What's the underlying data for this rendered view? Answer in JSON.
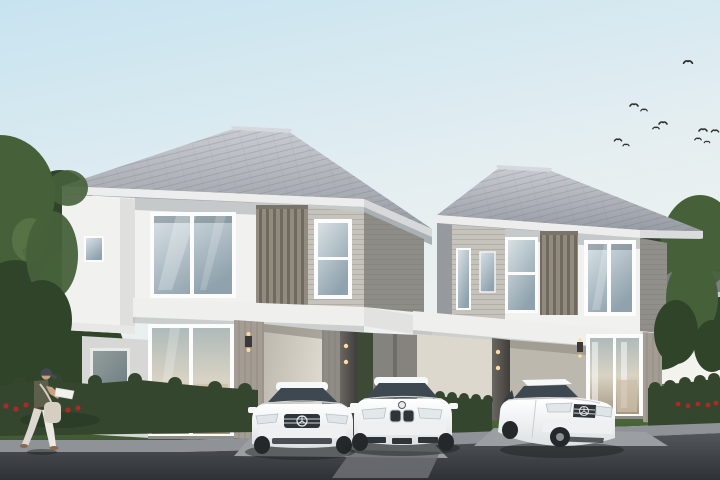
{
  "scene": {
    "description": "Daytime architectural rendering of two modern two-storey detached houses with carports, three parked white sedans, a pedestrian walking on the sidewalk, trimmed hedges with red flower beds, trees and a flock of birds",
    "objects": {
      "houses": [
        "left two-storey house with carport",
        "right two-storey house with carport"
      ],
      "vehicles": [
        "white sedan with three-pointed-star badge",
        "white sedan with twin-kidney grille badge",
        "white sedan with three-pointed-star badge"
      ],
      "person": "pedestrian with cap, sleeveless top, white trousers and cream shoulder bag walking right",
      "birds_count": 11,
      "landscaping": [
        "left tree group",
        "right tree group",
        "front hedge",
        "divider hedge",
        "right hedge",
        "red flower beds",
        "lawn"
      ],
      "background": [
        "neighbouring rooftops left",
        "neighbouring rooftops right"
      ]
    },
    "palette": {
      "sky_top": "#c7e3f0",
      "sky_mid": "#e4eef1",
      "sky_low": "#f4f3ee",
      "roof_light": "#c9ccd1",
      "roof_dark": "#979ba3",
      "roof_edge": "#6e727a",
      "ridge": "#d5d8dc",
      "fascia": "#ecedec",
      "eave_shadow": "#5f636a",
      "wall_white": "#f1f2f0",
      "wall_shade": "#d7d8d5",
      "siding_light": "#c6c3bc",
      "siding_shade": "#a9a69e",
      "slat_wood": "#918b7f",
      "band_white": "#eff0ee",
      "gf_siding": "#a39d94",
      "carport_beige": "#dcd8ce",
      "carport_shade": "#bcb8ad",
      "panel_gray": "#85837e",
      "pillar": "#54514d",
      "frame_white": "#fbfcfb",
      "glass_light": "#d8e1e5",
      "glass_dark": "#8fa2ad",
      "car_glass": "#3d4850",
      "interior_warm": "#cdbfa8",
      "tree_dark": "#2f4429",
      "tree_mid": "#46613a",
      "tree_light": "#5e7b4b",
      "hedge": "#35462e",
      "grass_light": "#5d7a45",
      "grass_dark": "#415a33",
      "flower_red": "#aa2b25",
      "driveway": "#9b9ea3",
      "curb": "#8f9296",
      "apron": "#6d7074",
      "road_top": "#53565b",
      "road_bottom": "#2e3135",
      "divider": "#797b7e",
      "car_white": "#f7f8f8",
      "car_trim": "#eef0f1",
      "car_dark": "#2f3439",
      "wheel_dark": "#25282b",
      "bird": "#2d2d2d",
      "bg_roof": "#7a7e85",
      "bg_wall": "#d6d7d5",
      "bg_win": "#6a7077",
      "cap": "#454a50",
      "top_olive": "#5b5f4c",
      "pants": "#ebe9e3",
      "skin": "#c9a183",
      "bag": "#d5cfc2",
      "shoe": "#8a684c",
      "glow": "#ffd9a0"
    }
  }
}
